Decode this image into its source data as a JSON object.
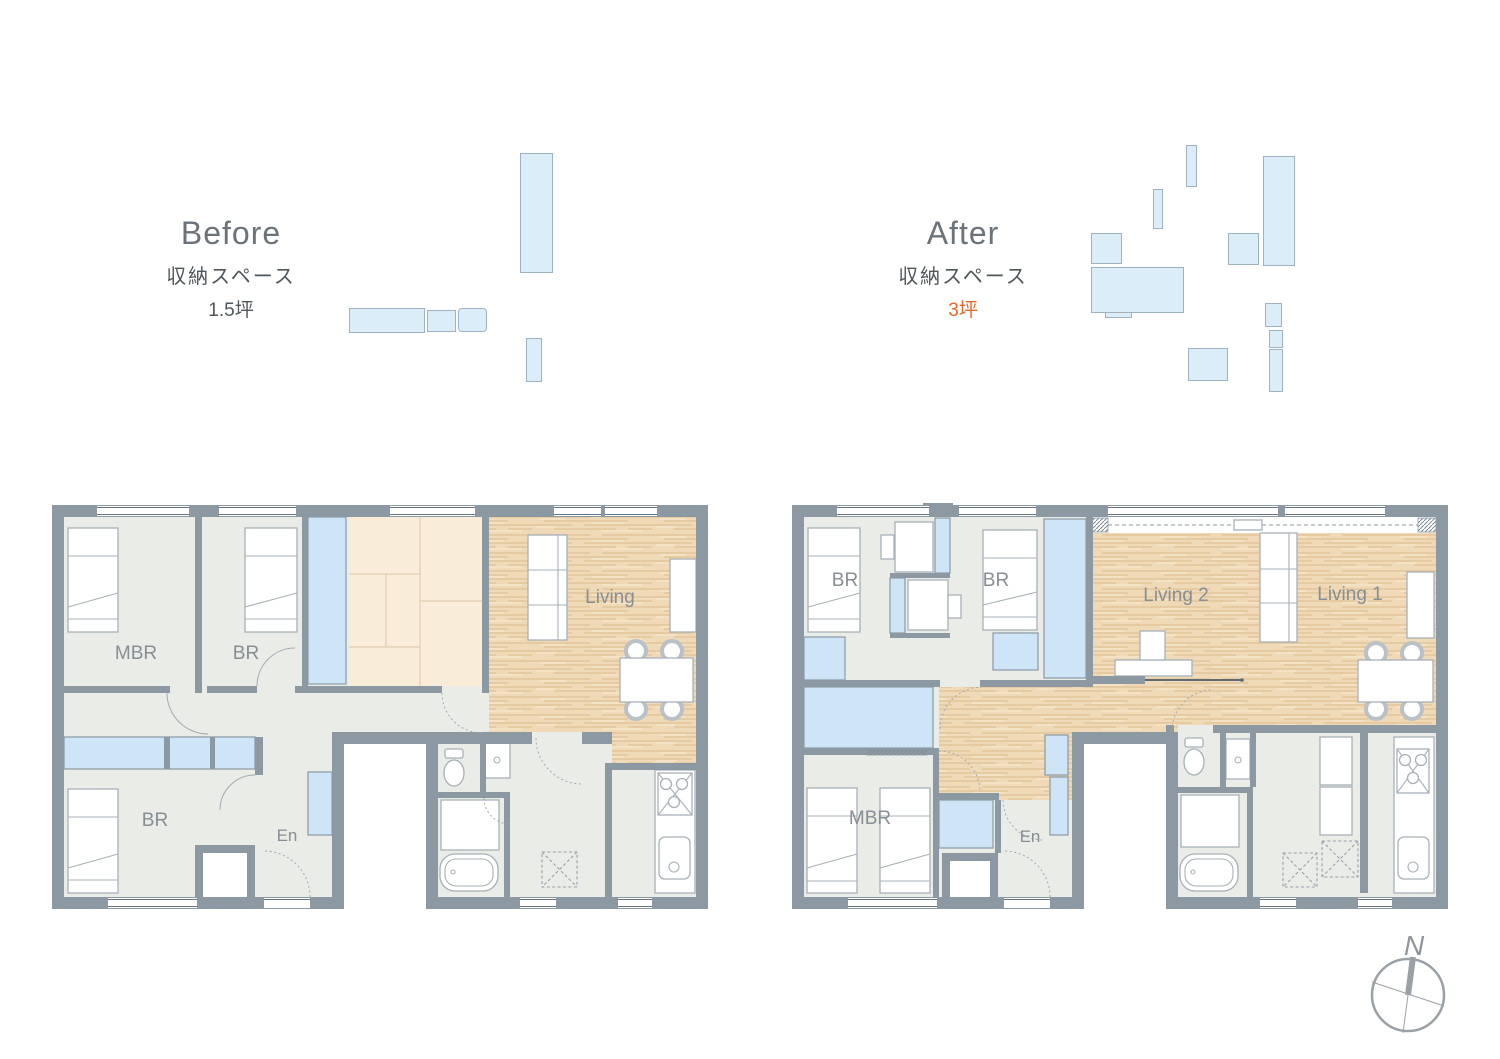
{
  "titles": {
    "before": {
      "title": "Before",
      "subtitle": "収納スペース",
      "area": "1.5坪"
    },
    "after": {
      "title": "After",
      "subtitle": "収納スペース",
      "area": "3坪"
    }
  },
  "before_plan": {
    "mbr": "MBR",
    "br_top": "BR",
    "living": "Living",
    "br_bottom": "BR",
    "entrance": "En"
  },
  "after_plan": {
    "br_left": "BR",
    "br_right": "BR",
    "living2": "Living 2",
    "living1": "Living 1",
    "mbr": "MBR",
    "entrance": "En"
  },
  "compass": {
    "north": "N"
  },
  "colors": {
    "wall": "#8c99a3",
    "floor": "#e9ece7",
    "closet_blue": "#cde5f6",
    "storage_blue": "#daedf9",
    "tatami": "#f9ecd9",
    "wood": "#efd9b6",
    "label": "#878e94",
    "accent_orange": "#e4682a"
  }
}
